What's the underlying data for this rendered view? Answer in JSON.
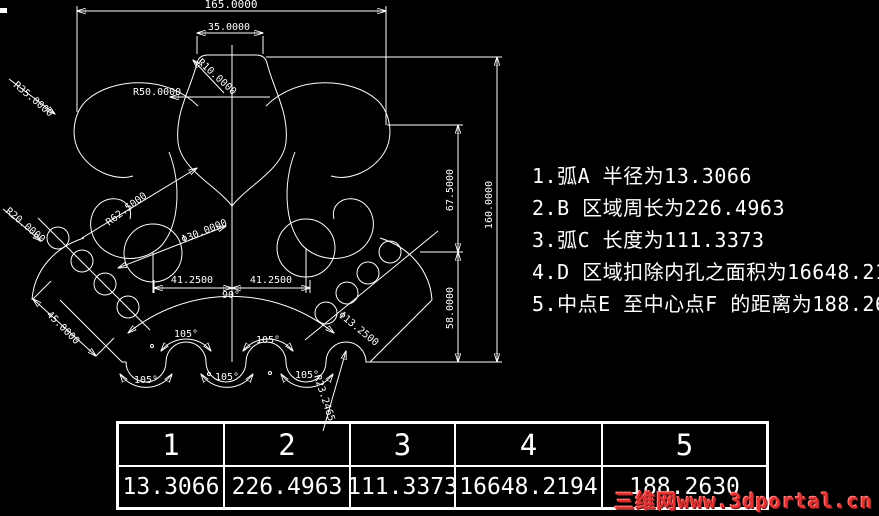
{
  "colors": {
    "background": "#000000",
    "lines": "#ffffff",
    "watermark_red": "#e23333"
  },
  "drawing": {
    "linear_dims": {
      "top_overall": "165.0000",
      "top_center": "35.0000",
      "mid_left": "41.2500",
      "mid_right": "41.2500",
      "right_upper": "67.5000",
      "right_lower": "58.0000",
      "right_overall": "160.0000",
      "bottom_left_slant": "45.0000"
    },
    "radius_dims": {
      "r10": "R10.0000",
      "r50": "R50.0000",
      "r35": "R35.0000",
      "r20": "R20.0000",
      "r62": "R62.5000",
      "r23": "R23.2465"
    },
    "diameter_dims": {
      "d30": "Φ30.0000",
      "d13": "Φ13.2500"
    },
    "angle_dims": {
      "fan": "90°",
      "scallops": [
        "105°",
        "105°",
        "105°",
        "105°",
        "105°"
      ]
    }
  },
  "notes": {
    "lines": [
      "1.弧A 半径为13.3066",
      "2.B 区域周长为226.4963",
      "3.弧C 长度为111.3373",
      "4.D 区域扣除内孔之面积为16648.2194",
      "5.中点E 至中心点F 的距离为188.2630"
    ]
  },
  "results_table": {
    "headers": [
      "1",
      "2",
      "3",
      "4",
      "5"
    ],
    "values": [
      "13.3066",
      "226.4963",
      "111.3373",
      "16648.2194",
      "188.2630"
    ]
  },
  "watermark": {
    "text": "三维网www.3dportal.cn"
  }
}
